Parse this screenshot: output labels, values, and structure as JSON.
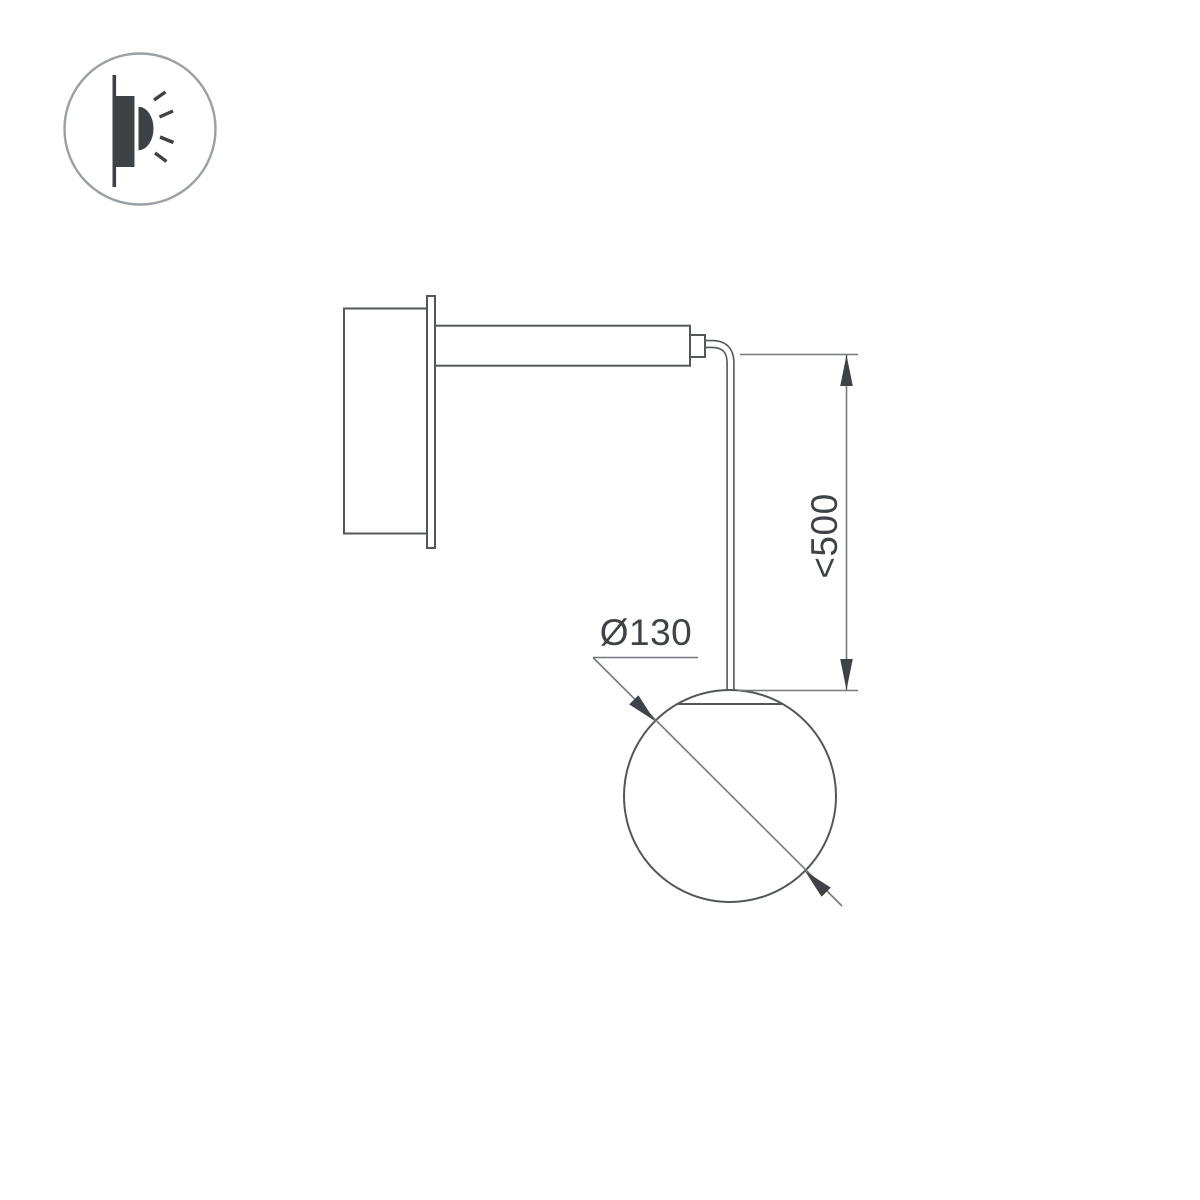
{
  "labels": {
    "diameter": "Ø130",
    "height": "<500"
  },
  "icons": {
    "badge": "wall-light-glow-icon"
  },
  "colors": {
    "background": "#ffffff",
    "line": "#53575a",
    "dim_line": "#75787c",
    "annotation": "#3f4347",
    "icon_fill": "#3e4245",
    "icon_ring": "#9ba0a4"
  }
}
